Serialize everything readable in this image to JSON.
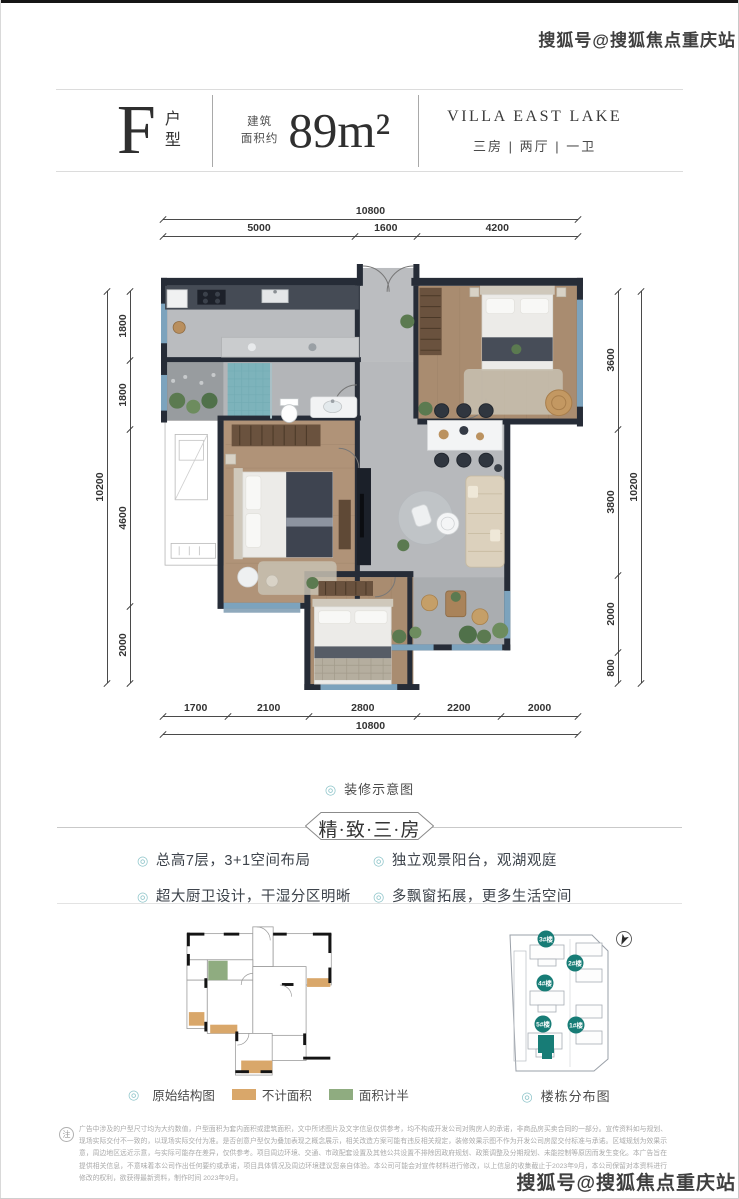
{
  "watermark": {
    "text": "搜狐号@搜狐焦点重庆站"
  },
  "header": {
    "unit_letter": "F",
    "unit_label": "户型",
    "area_prefix1": "建筑",
    "area_prefix2": "面积约",
    "area_value": "89m²",
    "project_name": "VILLA EAST LAKE",
    "layout_spec": "三房 | 两厅 | 一卫"
  },
  "plan": {
    "caption": "装修示意图",
    "dims": {
      "top_total": "10800",
      "top_segments": [
        "5000",
        "1600",
        "4200"
      ],
      "bottom_total": "10800",
      "bottom_segments": [
        "1700",
        "2100",
        "2800",
        "2200",
        "2000"
      ],
      "left_total": "10200",
      "left_segments": [
        "1800",
        "1800",
        "4600",
        "2000"
      ],
      "right_total": "10200",
      "right_segments": [
        "3600",
        "3800",
        "2000",
        "800"
      ]
    }
  },
  "section_title": "精·致·三·房",
  "features": [
    "总高7层，3+1空间布局",
    "独立观景阳台，观湖观庭",
    "超大厨卫设计，干湿分区明晰",
    "多飘窗拓展，更多生活空间"
  ],
  "diagram_left": {
    "caption": "原始结构图",
    "legend": [
      {
        "label": "不计面积",
        "color": "#d9a76a"
      },
      {
        "label": "面积计半",
        "color": "#8fac80"
      }
    ]
  },
  "diagram_right": {
    "caption": "楼栋分布图",
    "buildings": [
      "3#楼",
      "2#楼",
      "4#楼",
      "5#楼",
      "1#楼"
    ],
    "highlight": "5#楼"
  },
  "colors": {
    "accent_teal": "#177c76",
    "bullet_teal": "#8fc5ca",
    "wall": "#262c37",
    "wood_floor": "#a98c70",
    "marble_floor": "#b8babc",
    "window_blue": "#7ca3bd",
    "legend_tan": "#d9a76a",
    "legend_green": "#8fac80"
  },
  "note": {
    "icon": "注",
    "text": "广告中涉及的户型尺寸均为大约数值，户型面积为套内面积或建筑面积，文中所述图片及文字信息仅供参考，均不构成开发公司对购房人的承诺，非商品房买卖合同的一部分。宣传资料如与规划、现场实际交付不一致的，以现场实际交付为准。是否创意户型仅为叠加表现之概念展示，相关改造方案可能有违反相关规定，装修效果示图不作为开发公司房屋交付标准与承诺。区域规划为效果示意，周边地区远近示意，与实际可能存在差异，仅供参考。项目周边环境、交通、市政配套设置及其他公共设置不排除因政府规划、政策调整及分期规划、未能控制等原因而发生变化。本广告旨在提供相关信息，不意味着本公司作出任何要约或承诺，项目具体情况及周边环境建议您亲自体验。本公司可能会对宣传材料进行修改，以上信息的收集截止于2023年9月，本公司保留对本资料进行修改的权利，欲获得最新资料，制作时间 2023年9月。"
  }
}
